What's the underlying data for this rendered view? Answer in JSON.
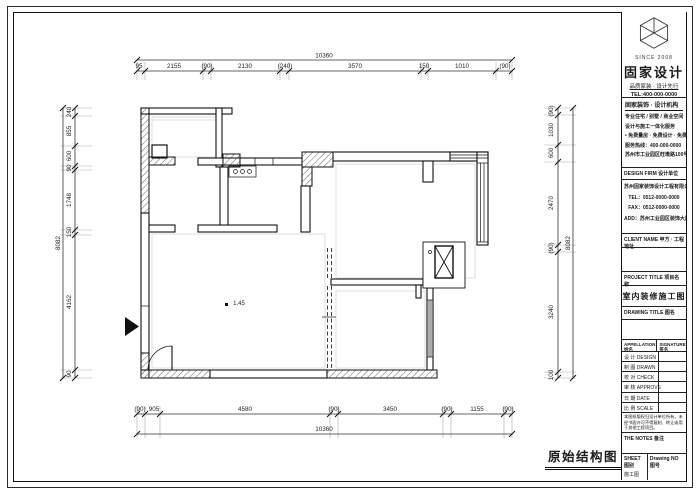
{
  "sheet": {
    "drawing_label": "原始结构图"
  },
  "colors": {
    "line": "#1a1a1a",
    "hatch": "#555555",
    "guide": "#dcdcdc"
  },
  "plan": {
    "level_marker": "1.45",
    "dims": {
      "top": {
        "overall": "10360",
        "segments": [
          "95",
          "2155",
          "(90)",
          "2130",
          "(240)",
          "3570",
          "150",
          "1010",
          "(90)"
        ]
      },
      "bottom": {
        "overall": "10360",
        "segments": [
          "(90)",
          "905",
          "4580",
          "(90)",
          "3450",
          "(90)",
          "1155",
          "(90)"
        ]
      },
      "left": {
        "overall": "8082",
        "segments": [
          "240",
          "855",
          "600",
          "90",
          "1748",
          "150",
          "4162",
          "90"
        ]
      },
      "right": {
        "overall": "8082",
        "segments": [
          "(90)",
          "1030",
          "600",
          "2470",
          "(90)",
          "3240",
          "100"
        ]
      }
    }
  },
  "title_block": {
    "logo": {
      "company": "固家设计",
      "since": "SINCE 2008",
      "tagline": "品质家装 · 设计先行",
      "tel": "TEL:400-000-0000"
    },
    "about": {
      "header": "固家装饰 · 设计机构",
      "lines": [
        "专业住宅 / 别墅 / 商业空间",
        "设计与施工一体化服务",
        "• 免费量房 · 免费设计 · 免费报价",
        "服务热线：400-000-0000",
        "苏州市工业园区旺墩路100号"
      ]
    },
    "firm": {
      "header": "DESIGN FIRM 设计单位",
      "lines": [
        "苏州固家装饰设计工程有限公司",
        "TEL：0512-0000-0000",
        "FAX：0512-0000-0000",
        "ADD：苏州工业园区装饰大厦"
      ]
    },
    "client": {
      "header": "CLIENT NAME 甲方 · 工程地址"
    },
    "project": {
      "header": "PROJECT TITLE 项目名称",
      "value": "室内装修施工图"
    },
    "drawing": {
      "header": "DRAWING TITLE 图名"
    },
    "sign_table": {
      "col1": "APPELLATION 姓名",
      "col2": "SIGNATURE 签名",
      "rows": [
        "设 计 DESIGN",
        "制 图 DRAWN",
        "校 对 CHECK",
        "审 核 APPROVE",
        "日 期 DATE",
        "比 例 SCALE"
      ]
    },
    "note": "本图纸版权归设计单位所有，未经书面许可不得复制、转让或用于其他工程项目。",
    "remark_label": "THE NOTES 备注",
    "bottom": {
      "left_label": "SHEET 图别",
      "left_value": "施工图",
      "right_label": "Drawing NO 图号",
      "right_value": ""
    }
  }
}
